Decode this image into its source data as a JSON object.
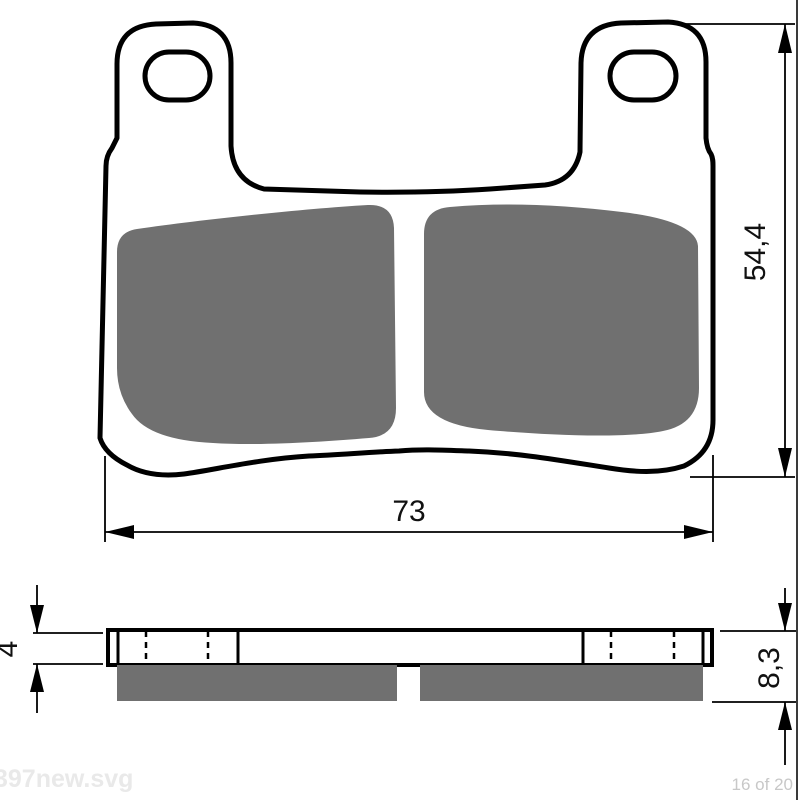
{
  "page": {
    "background": "#ffffff",
    "watermark_left": "397new.svg",
    "watermark_right": "16 of 20"
  },
  "drawing": {
    "subject": "brake-pad-technical-drawing",
    "colors": {
      "outline": "#000000",
      "friction_material": "#707070",
      "dimension": "#000000",
      "watermark_left": "#e9e9e9",
      "watermark_right": "#c8c8c8",
      "page_border": "#3a3a3a"
    },
    "dimensions": {
      "pad_width": {
        "label": "73"
      },
      "pad_height": {
        "label": "54,4"
      },
      "plate_thickness": {
        "label": "4"
      },
      "total_thickness": {
        "label": "8,3"
      }
    }
  }
}
